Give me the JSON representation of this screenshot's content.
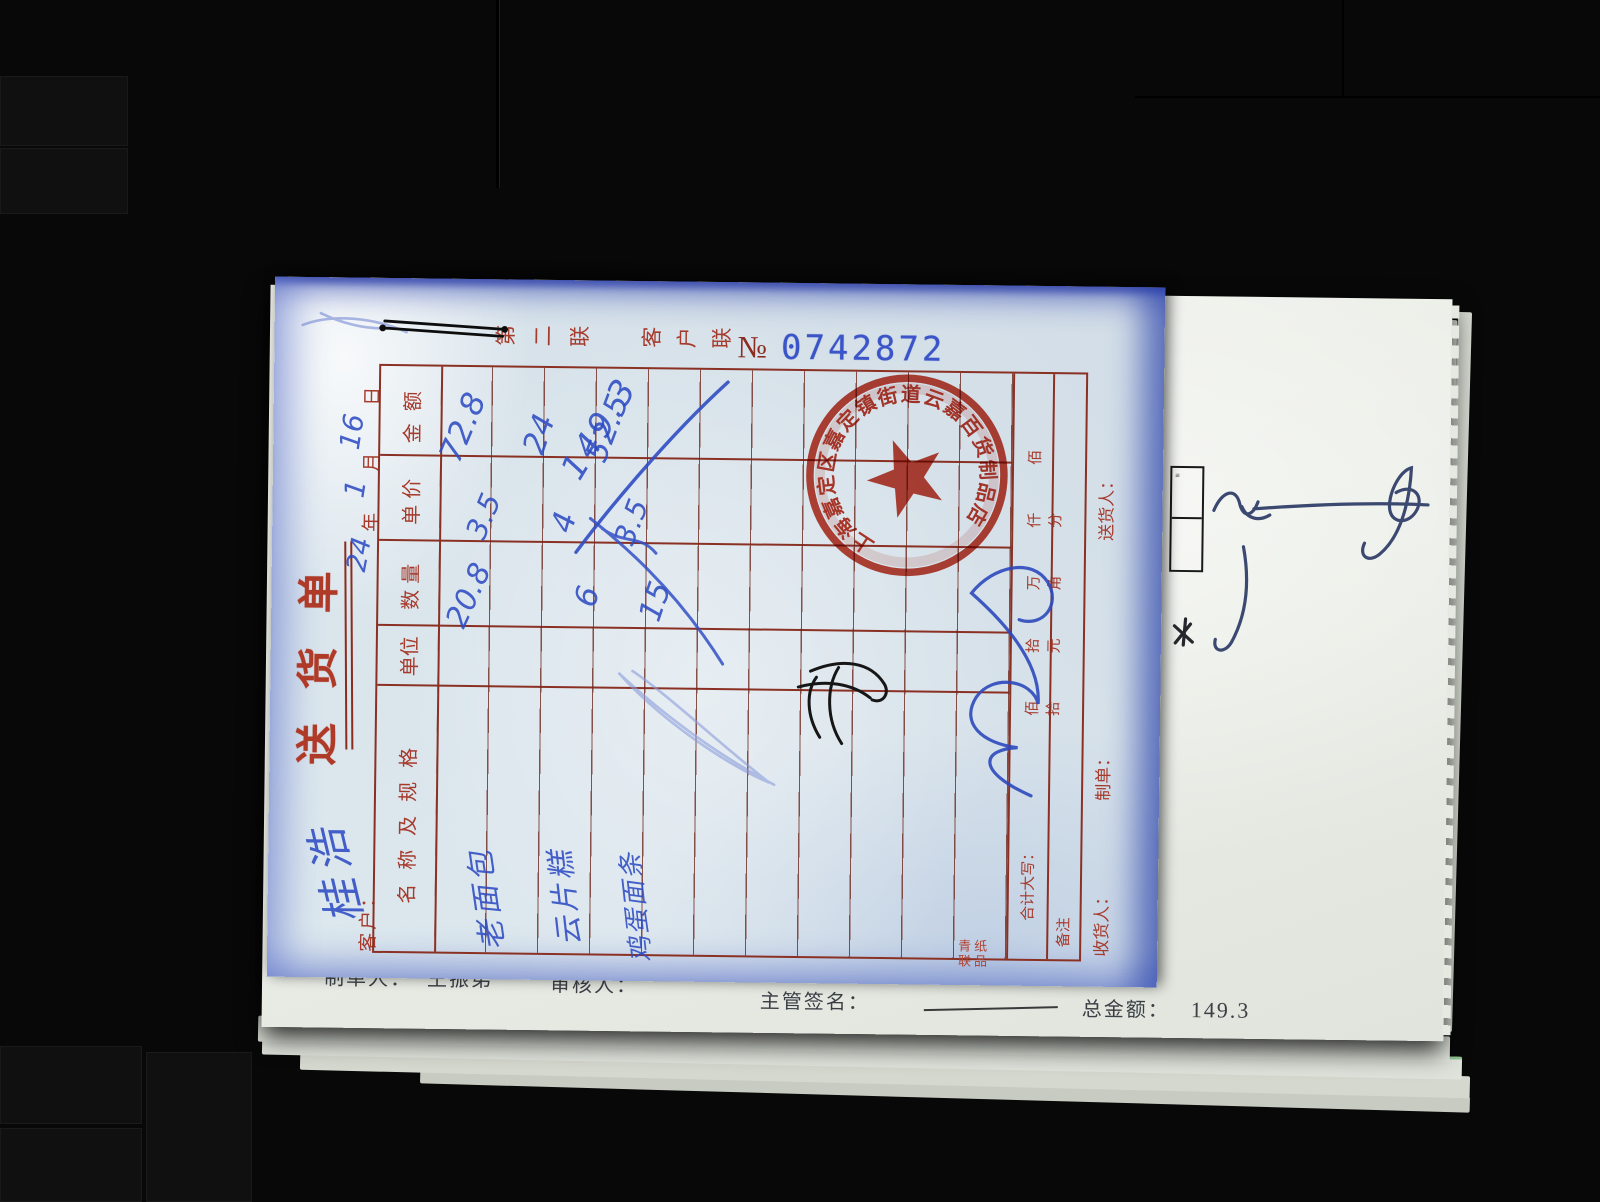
{
  "form": {
    "title": "送货单",
    "copy_labels": {
      "first": "第二联",
      "second": "客户联"
    },
    "serial": {
      "prefix": "№",
      "number": "0742872"
    },
    "customer": {
      "label": "客户：",
      "name_handwritten": "桂浩"
    },
    "date": {
      "year_handwritten": "24",
      "year_label": "年",
      "month_handwritten": "1",
      "month_label": "月",
      "day_handwritten": "16",
      "day_label": "日"
    },
    "table": {
      "headers": {
        "name": "名称及规格",
        "unit": "单位",
        "qty": "数量",
        "price": "单价",
        "amount": "金额"
      },
      "rows": [
        {
          "name": "老面包",
          "qty": "20.8",
          "price": "3.5",
          "amount": "72.8"
        },
        {
          "name": "云片糕",
          "qty": "6",
          "price": "4",
          "amount": "24"
        },
        {
          "name": "鸡蛋面条",
          "qty": "15",
          "price": "3.5",
          "amount": "52.5"
        }
      ],
      "total_handwritten": "149.3",
      "caps_label": "合计大写：",
      "caps_units": "佰 拾 万 仟 佰 拾 元 角 分",
      "remarks_label": "备注"
    },
    "footer": {
      "receiver": "收货人：",
      "preparer": "制单：",
      "deliverer": "送货人："
    },
    "printer_brand": "青联纸品",
    "stamp": {
      "ring_text": "上海嘉定区嘉定镇街道云嘉百货制品店"
    }
  },
  "undersheet": {
    "preparer_label": "制单人：",
    "preparer_name": "王振弟",
    "reviewer_label": "审核人：",
    "supervisor_label": "主管签名：",
    "total_label": "总金额：",
    "total_value": "149.3"
  },
  "colors": {
    "form_red": "#a63a2b",
    "handwriting_blue": "#2e4cc3",
    "stamp_red": "#bd2b1a",
    "serial_blue": "#3b55c8"
  }
}
